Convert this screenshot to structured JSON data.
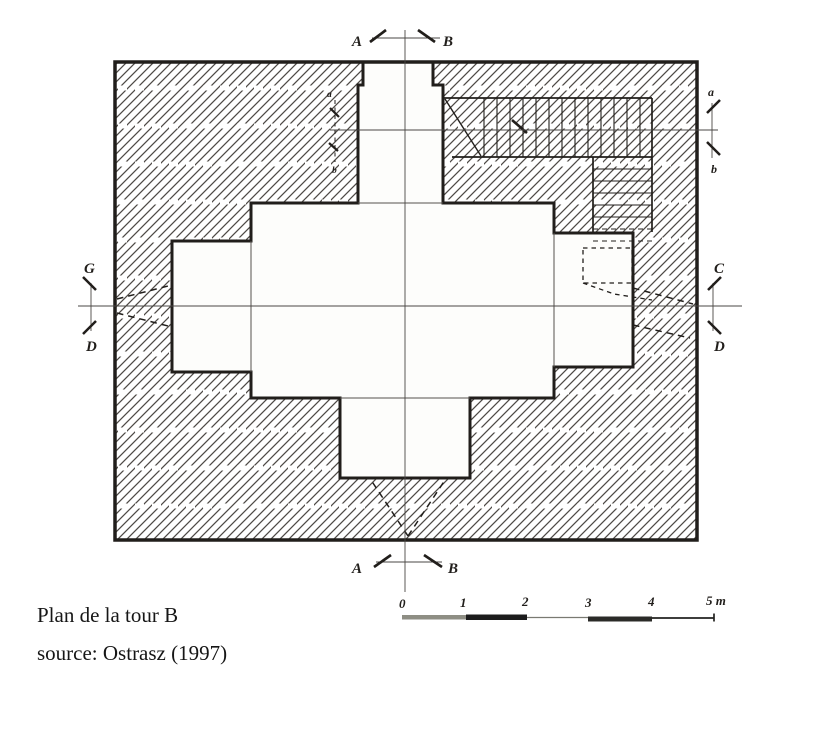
{
  "figure": {
    "title": "Plan de la tour B",
    "source_line": "source: Ostrasz (1997)"
  },
  "markers": {
    "top": {
      "a": "A",
      "b": "B"
    },
    "bottom": {
      "a": "A",
      "b": "B"
    },
    "right_section": {
      "a": "a",
      "b": "b"
    },
    "right_axis": {
      "c": "C",
      "d": "D"
    },
    "left_axis": {
      "g": "G",
      "d": "D"
    },
    "wall_section": {
      "a": "a",
      "b": "b"
    }
  },
  "scale_bar": {
    "ticks": [
      "0",
      "1",
      "2",
      "3",
      "4",
      "5 m"
    ]
  },
  "colors": {
    "ink": "#211e1b",
    "hatch": "#4e4a45",
    "paper": "#fdfdfb",
    "thin_line": "#4a4744"
  }
}
